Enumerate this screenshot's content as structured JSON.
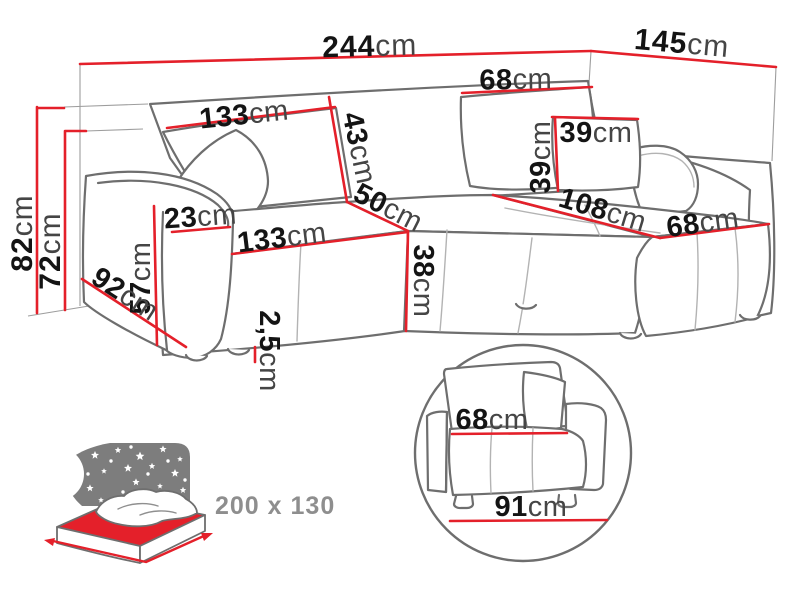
{
  "diagram_type": "corner-sofa-dimension-diagram",
  "colors": {
    "dimension_red": "#e4202a",
    "outline_gray": "#6e6e6e",
    "sky_gray": "#7d7d7d",
    "annotation_text_gray": "#8e8e8e"
  },
  "sofa_dimensions": {
    "total_width": {
      "value": "244",
      "unit": "cm"
    },
    "total_depth": {
      "value": "145",
      "unit": "cm"
    },
    "backrest_left_width": {
      "value": "133",
      "unit": "cm"
    },
    "backrest_right_width": {
      "value": "68",
      "unit": "cm"
    },
    "backrest_height": {
      "value": "43",
      "unit": "cm"
    },
    "cushion_width": {
      "value": "39",
      "unit": "cm"
    },
    "cushion_height": {
      "value": "39",
      "unit": "cm"
    },
    "total_height": {
      "value": "82",
      "unit": "cm"
    },
    "frame_height": {
      "value": "72",
      "unit": "cm"
    },
    "armrest_width": {
      "value": "23",
      "unit": "cm"
    },
    "armrest_height": {
      "value": "57",
      "unit": "cm"
    },
    "armrest_depth": {
      "value": "92",
      "unit": "cm"
    },
    "seat_width": {
      "value": "133",
      "unit": "cm"
    },
    "seat_corner_depth": {
      "value": "50",
      "unit": "cm"
    },
    "seat_height": {
      "value": "38",
      "unit": "cm"
    },
    "chaise_length": {
      "value": "108",
      "unit": "cm"
    },
    "chaise_width": {
      "value": "68",
      "unit": "cm"
    },
    "leg_height": {
      "value": "2,5",
      "unit": "cm"
    }
  },
  "detail_view": {
    "seat_depth": {
      "value": "68",
      "unit": "cm"
    },
    "total_depth": {
      "value": "91",
      "unit": "cm"
    }
  },
  "sleeping_function": {
    "bed_size": "200 x 130"
  }
}
